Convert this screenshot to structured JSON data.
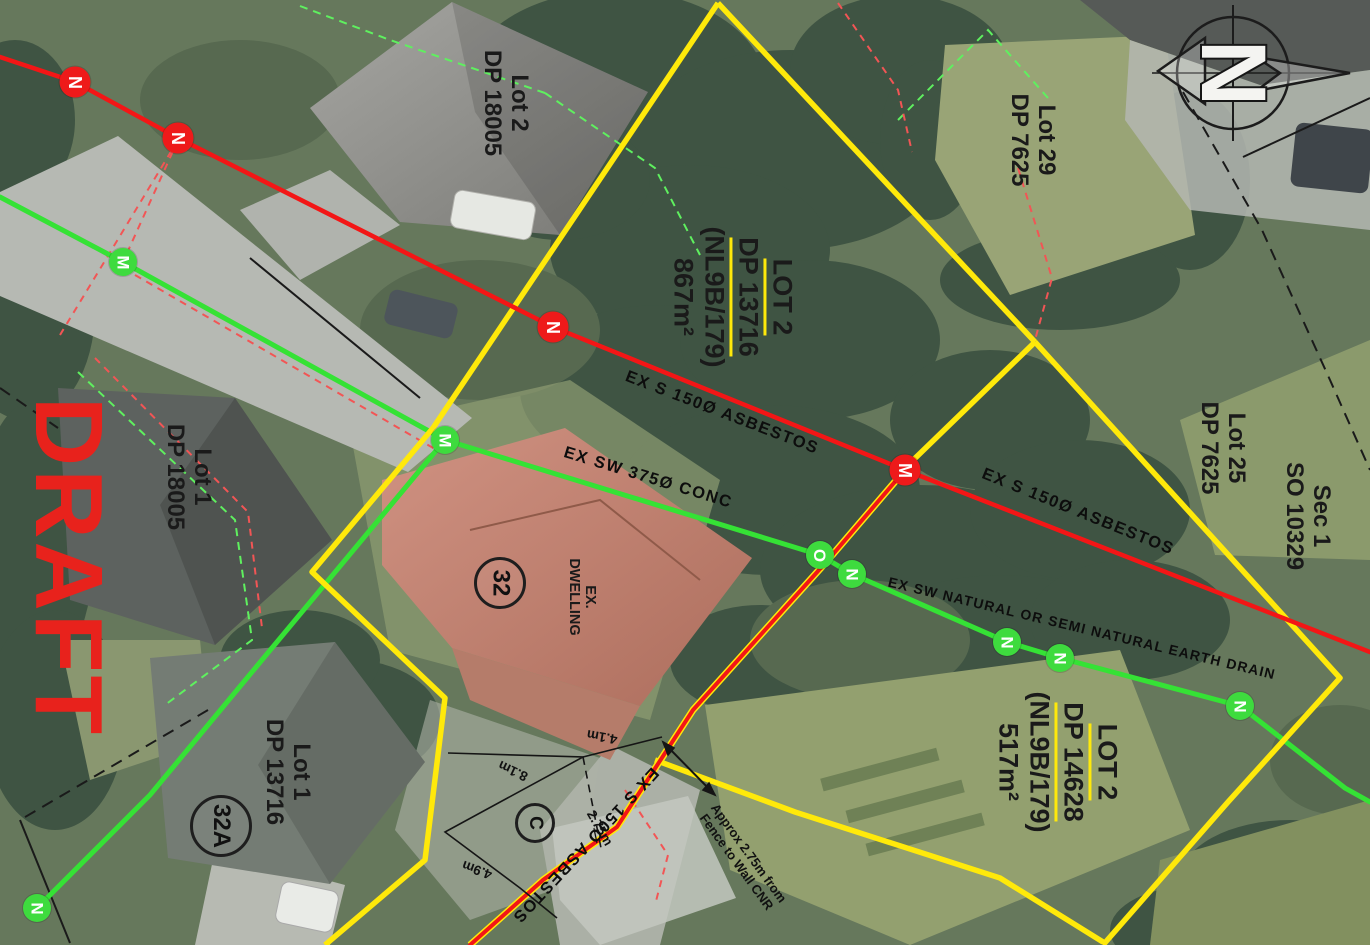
{
  "watermark": "DRAFT",
  "compass_letter": "N",
  "parcels": {
    "p1": {
      "l1": "Lot 2",
      "l2": "DP 18005"
    },
    "p2": {
      "l1": "Lot 29",
      "l2": "DP 7625"
    },
    "p3": {
      "l1": "LOT 2",
      "l2": "DP 13716",
      "l3": "(NL9B/179)",
      "l4": "867m²"
    },
    "p4": {
      "l1": "Lot 1",
      "l2": "DP 18005"
    },
    "p5": {
      "l1": "Lot 1",
      "l2": "DP 13716"
    },
    "p6": {
      "l1": "LOT 2",
      "l2": "DP 14628",
      "l3": "(NL9B/179)",
      "l4": "517m²"
    },
    "p7": {
      "l1": "Lot 25",
      "l2": "DP 7625"
    },
    "p8": {
      "l1": "Sec 1",
      "l2": "SO 10329"
    }
  },
  "pipes": {
    "sewer1": "EX S 150Ø ASBESTOS",
    "sewer2": "EX S 150Ø ASBESTOS",
    "sewer3": "EX S 150Ø ASBESTOS",
    "storm": "EX SW 375Ø CONC",
    "drain": "EX SW NATURAL OR  SEMI NATURAL EARTH DRAIN"
  },
  "dwelling": {
    "l1": "EX.",
    "l2": "DWELLING"
  },
  "house_numbers": {
    "n32": "32",
    "n32a": "32A"
  },
  "area_label": "C",
  "measurements": {
    "m41": "4.1m",
    "m81": "8.1m",
    "m275": "2.75m",
    "m49": "4.9m"
  },
  "note": {
    "l1": "Approx 2.75m from",
    "l2": "Fence to Wall CNR"
  },
  "markers": {
    "r1": "N",
    "r2": "N",
    "r3": "N",
    "r4": "M",
    "g1": "M",
    "g2": "M",
    "g3": "O",
    "g4": "N",
    "g5": "N",
    "g6": "N",
    "g7": "N",
    "g8": "N"
  },
  "colors": {
    "sewer_red": "#f31616",
    "stormwater_green": "#35e235",
    "boundary_yellow": "#ffe90a",
    "draft_red": "#e8221c"
  }
}
